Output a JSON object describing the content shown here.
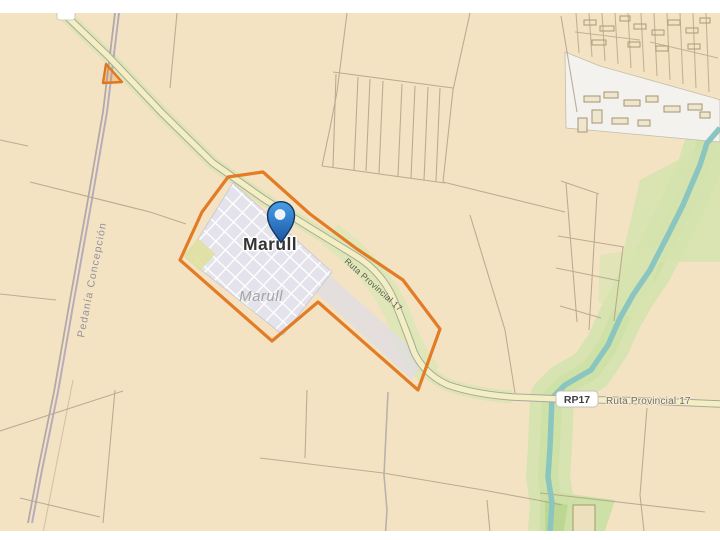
{
  "map": {
    "town_label": "Marull",
    "area_label": "Marull",
    "district_label": "Pedanía Concepción",
    "road_label_diagonal": "Ruta Provincial 17",
    "road_badge": "RP17",
    "road_label_horizontal": "Ruta Provincial 17",
    "marker": {
      "type": "location-pin",
      "place": "Marull"
    },
    "colors": {
      "parcel_beige": "#f4e3c3",
      "parcel_line": "#b3a28a",
      "road_fill": "#f3efc3",
      "road_casing": "#a9a89e",
      "road_green_edge": "#d9e4b0",
      "river": "#8ac6bf",
      "vegetation": "#d5e3af",
      "town_fill": "#e4e2ea",
      "town_streets": "#ffffff",
      "built_area": "#f3f2ee",
      "boundary_orange": "#e0761d",
      "admin_boundary": "#a79dbb",
      "pin_blue_dark": "#1c55a3",
      "label_dark": "#343434",
      "label_gray": "#9b9b9b"
    }
  }
}
